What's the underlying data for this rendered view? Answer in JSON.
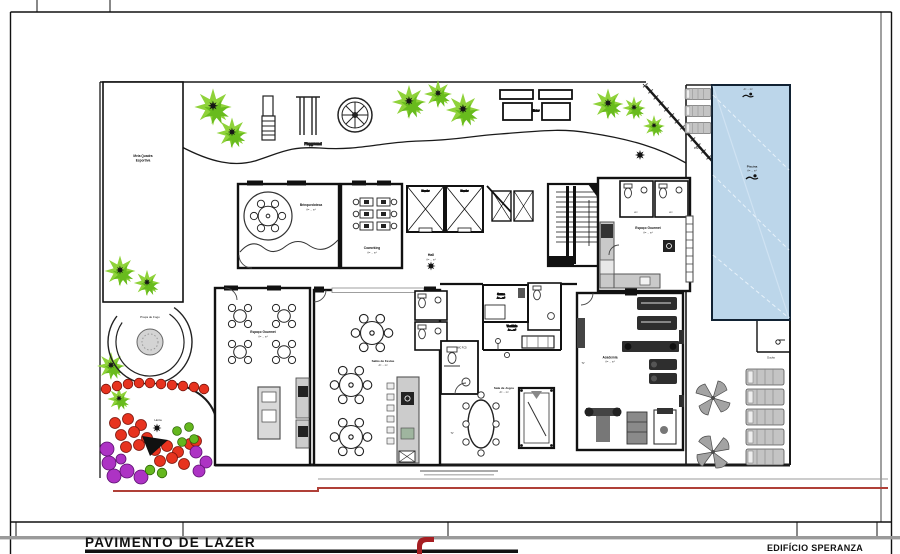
{
  "title_block": {
    "drawing_title": "PAVIMENTO DE LAZER",
    "project_name": "EDIFÍCIO SPERANZA"
  },
  "site": {
    "half_court_line1": "Meia Quadra",
    "half_court_line2": "Esportiva",
    "playground": "Playground",
    "seating": "Estar",
    "fire_plaza": "Praça de Fogo",
    "vegetable_garden": "Horta",
    "pool_deck": "Prainha",
    "shower": "Ducha"
  },
  "rooms": {
    "brinquedoteca": {
      "name": "Brinquedoteca",
      "area": "A= ... m²"
    },
    "coworking": {
      "name": "Coworking",
      "area": "A= ... m²"
    },
    "elevator": {
      "name": "Elevador"
    },
    "hall": {
      "name": "Hall",
      "area": "A= ... m²"
    },
    "gourmet_upper": {
      "name": "Espaço Gourmet",
      "area": "A= ... m²"
    },
    "gourmet_lower": {
      "name": "Espaço Gourmet",
      "area": "A= ... m²"
    },
    "party_room": {
      "name": "Salão de Festas",
      "area": "A= ... m²"
    },
    "game_room": {
      "name": "Sala de Jogos",
      "area": "A= ... m²"
    },
    "sauna": {
      "name": "Sauna",
      "area": "A= ... m²"
    },
    "changing_room": {
      "name": "Vestiário",
      "area": "A= ... m²"
    },
    "wc_accessible": {
      "name": "WC PCD"
    },
    "wc": {
      "name": "WC"
    },
    "gym": {
      "name": "Academia",
      "area": "A= ... m²"
    },
    "pool": {
      "name": "Piscina",
      "area": "A= ... m²"
    },
    "tv": "TV"
  },
  "colors": {
    "pool_fill": "#bcd6ea",
    "tree_light": "#8fd23a",
    "tree_dark": "#68bb1d",
    "bush_red": "#e7331f",
    "bush_purple": "#ad33c4",
    "bush_green": "#64b71e",
    "logo_red": "#a61e22",
    "ground_line_red": "#b04038"
  }
}
